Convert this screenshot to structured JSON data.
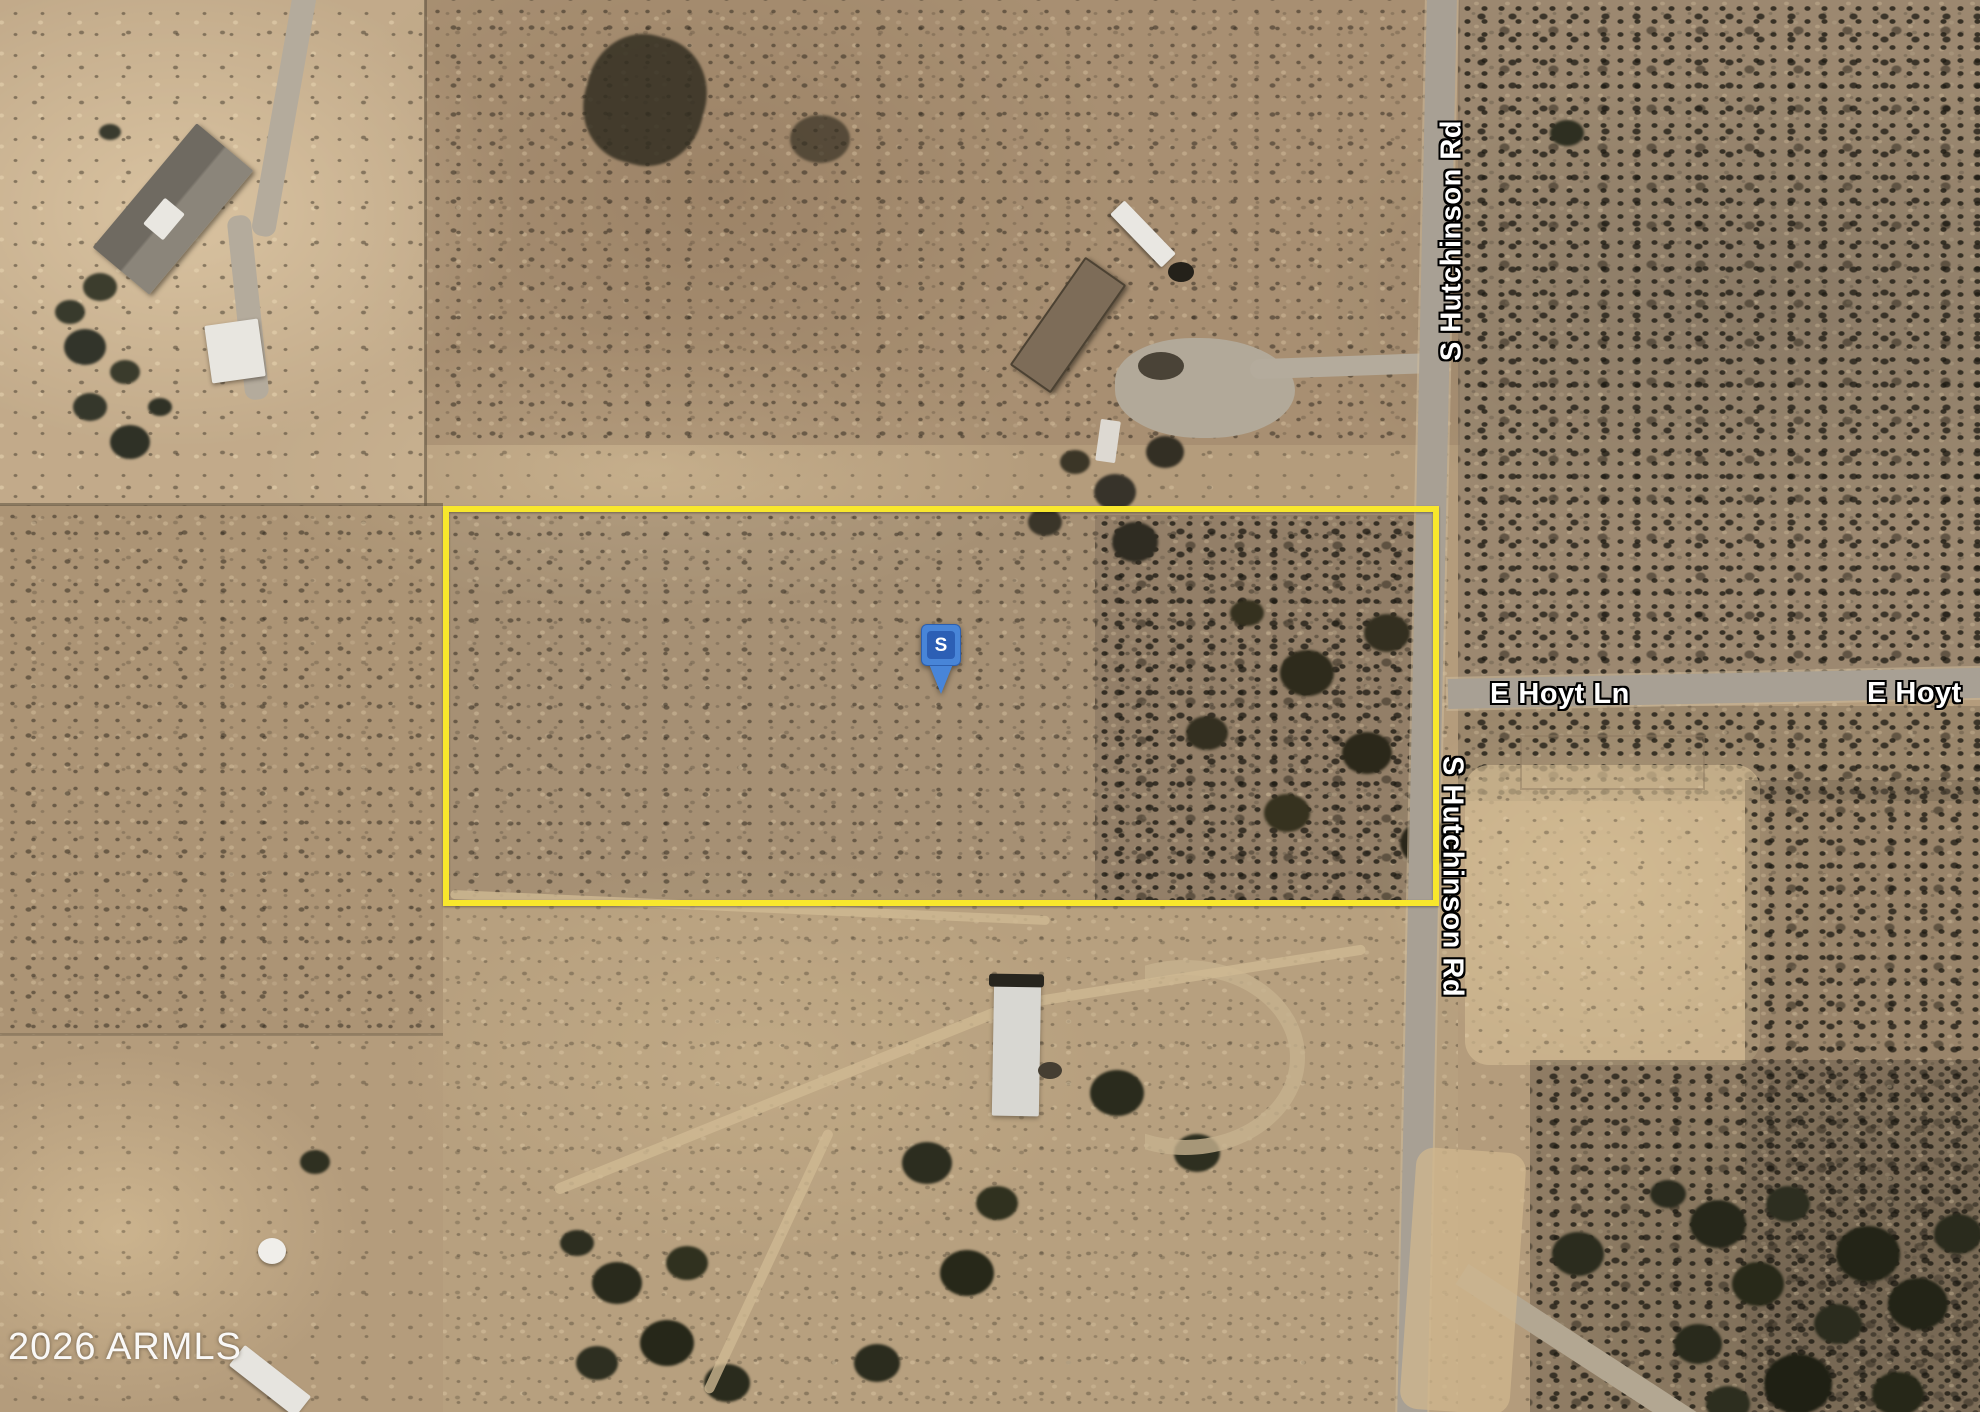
{
  "map": {
    "marker": {
      "letter": "S"
    },
    "road_labels": {
      "hutchinson_north": "S Hutchinson Rd",
      "hutchinson_south": "S Hutchinson Rd",
      "hoyt": "E Hoyt Ln",
      "hoyt_right_truncated": "E Hoyt"
    },
    "watermark": "2026 ARMLS",
    "colors": {
      "boundary_yellow": "#F8E72C",
      "marker_blue": "#4885D8",
      "marker_inner_blue": "#2C5FB5",
      "label_text": "#FFFFFF",
      "label_outline": "#000000",
      "road_gray": "#A8A094",
      "terrain_tan": "#B49C7C"
    }
  }
}
